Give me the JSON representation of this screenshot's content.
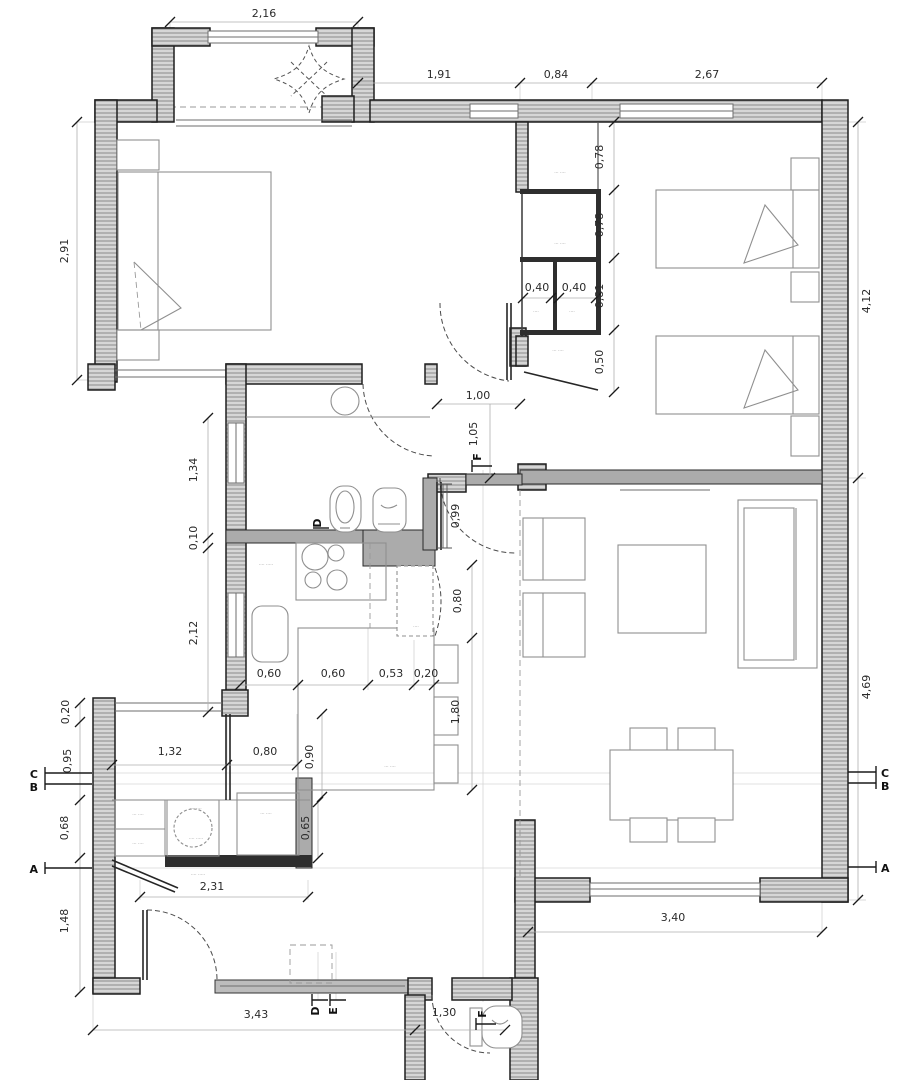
{
  "drawing": {
    "kind": "apartment floor plan",
    "wall_fill": "#d6d6d6",
    "hatch_line": "#8a8a8a",
    "line_dark": "#1f1f1f"
  },
  "dims": {
    "bay_width": "2,16",
    "top_a": "1,91",
    "top_b": "0,84",
    "top_c": "2,67",
    "left_a": "2,91",
    "left_b": "1,34",
    "left_c": "0,10",
    "left_d": "2,12",
    "left_e": "0,20",
    "left_f": "0,95",
    "left_g": "0,68",
    "left_h": "1,48",
    "right_a": "4,12",
    "right_b": "4,69",
    "closet_a": "0,78",
    "closet_b": "0,78",
    "closet_c": "0,40",
    "closet_d": "0,40",
    "closet_e": "0,81",
    "closet_f": "0,50",
    "hall_a": "1,00",
    "hall_b": "1,05",
    "hall_c": "0,99",
    "kit_a": "0,80",
    "kit_b": "0,60",
    "kit_c": "0,60",
    "kit_d": "0,53",
    "kit_e": "0,20",
    "kit_f": "1,80",
    "laun_a": "1,32",
    "laun_b": "0,80",
    "laun_c": "0,90",
    "laun_d": "0,65",
    "laun_e": "2,31",
    "bot_a": "3,40",
    "bot_b": "3,43",
    "bot_c": "1,30"
  },
  "markers": {
    "a": "A",
    "b": "B",
    "c": "C",
    "d": "D",
    "e": "E",
    "f": "F"
  },
  "tiny": {
    "s": "····",
    "m": "··· ····",
    "l": "···· ·····"
  }
}
